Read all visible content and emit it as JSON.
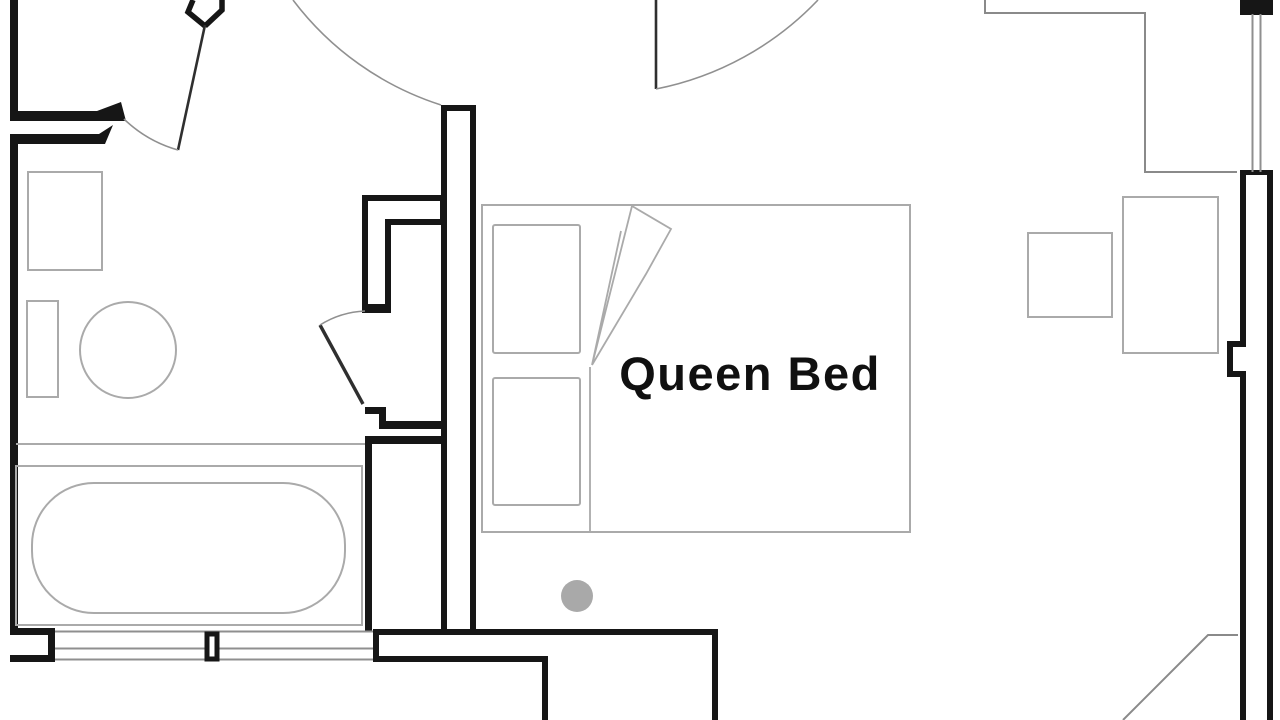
{
  "labels": {
    "queen_bed": "Queen Bed"
  },
  "colors": {
    "wall": "#161616",
    "door": "#2f2f2f",
    "swing": "#909090",
    "window": "#8f8f8f",
    "partition": "#8a8a8a",
    "fixture": "#aaaaaa",
    "dot": "#a9a9a9",
    "text": "#101010",
    "background": "#ffffff"
  }
}
